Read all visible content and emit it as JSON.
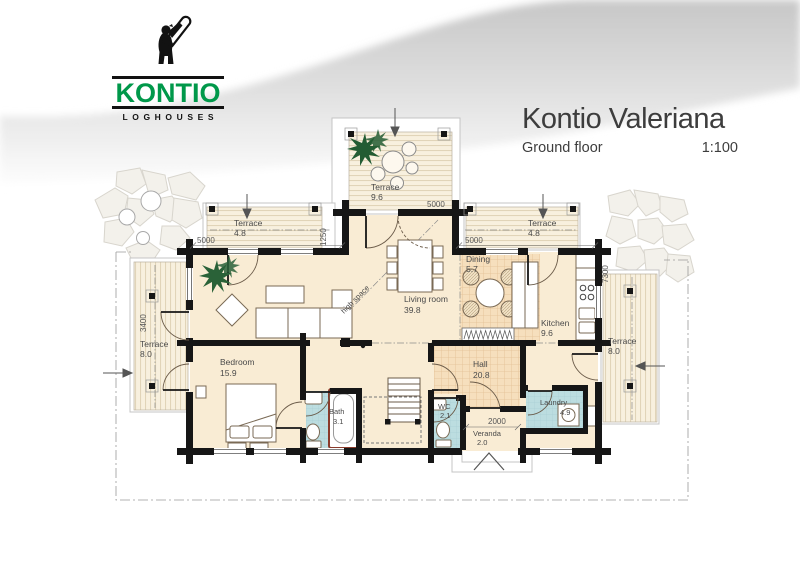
{
  "logo": {
    "brand": "KONTIO",
    "tagline": "LOGHOUSES"
  },
  "header": {
    "title": "Kontio Valeriana",
    "subtitle": "Ground floor",
    "scale": "1:100"
  },
  "plan": {
    "annotation": "high space",
    "rooms": [
      {
        "id": "terrace-top",
        "name": "Terrace",
        "area": "9.6"
      },
      {
        "id": "terrace-nw",
        "name": "Terrace",
        "area": "4.8"
      },
      {
        "id": "terrace-ne",
        "name": "Terrace",
        "area": "4.8"
      },
      {
        "id": "dining",
        "name": "Dining",
        "area": "5.7"
      },
      {
        "id": "living-room",
        "name": "Living room",
        "area": "39.8"
      },
      {
        "id": "kitchen",
        "name": "Kitchen",
        "area": "9.6"
      },
      {
        "id": "terrace-west",
        "name": "Terrace",
        "area": "8.0"
      },
      {
        "id": "terrace-east",
        "name": "Terrace",
        "area": "8.0"
      },
      {
        "id": "bedroom",
        "name": "Bedroom",
        "area": "15.9"
      },
      {
        "id": "hall",
        "name": "Hall",
        "area": "20.8"
      },
      {
        "id": "bath",
        "name": "Bath",
        "area": "3.1"
      },
      {
        "id": "wc",
        "name": "WC",
        "area": "2.1"
      },
      {
        "id": "veranda",
        "name": "Veranda",
        "area": "2.0"
      },
      {
        "id": "laundry",
        "name": "Laundry",
        "area": "4.9"
      }
    ],
    "dimensions": {
      "top_left": "5000",
      "bay_offset": "1250",
      "terrace_top": "5000",
      "top_right": "5000",
      "right_depth": "7300",
      "left_depth": "3400",
      "veranda_width": "2000"
    }
  },
  "colors": {
    "brand_green": "#00984a",
    "wall_black": "#161616",
    "floor_cream": "#f9ecd4",
    "wet_blue": "#bcdde0",
    "deck_tan": "#f8f0de"
  }
}
